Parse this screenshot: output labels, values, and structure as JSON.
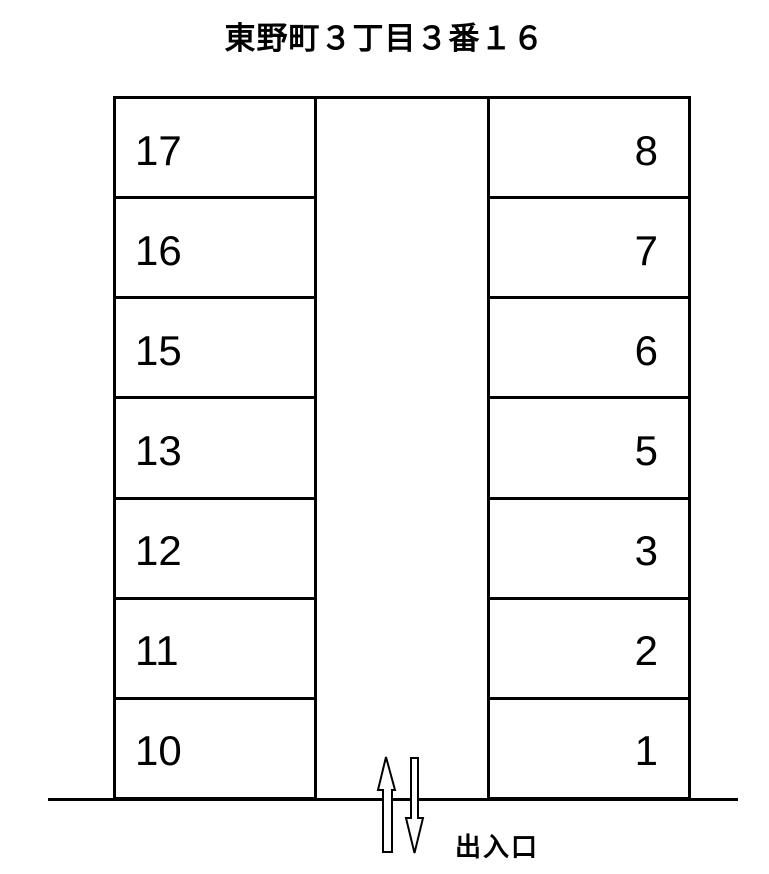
{
  "title": "東野町３丁目３番１６",
  "parking_lot": {
    "left_column_spaces": [
      "17",
      "16",
      "15",
      "13",
      "12",
      "11",
      "10"
    ],
    "right_column_spaces": [
      "8",
      "7",
      "6",
      "5",
      "3",
      "2",
      "1"
    ],
    "entrance_label": "出入口",
    "arrow_icons": [
      "up-arrow",
      "down-arrow"
    ]
  },
  "colors": {
    "line": "#000000",
    "background": "#ffffff",
    "text": "#000000"
  }
}
